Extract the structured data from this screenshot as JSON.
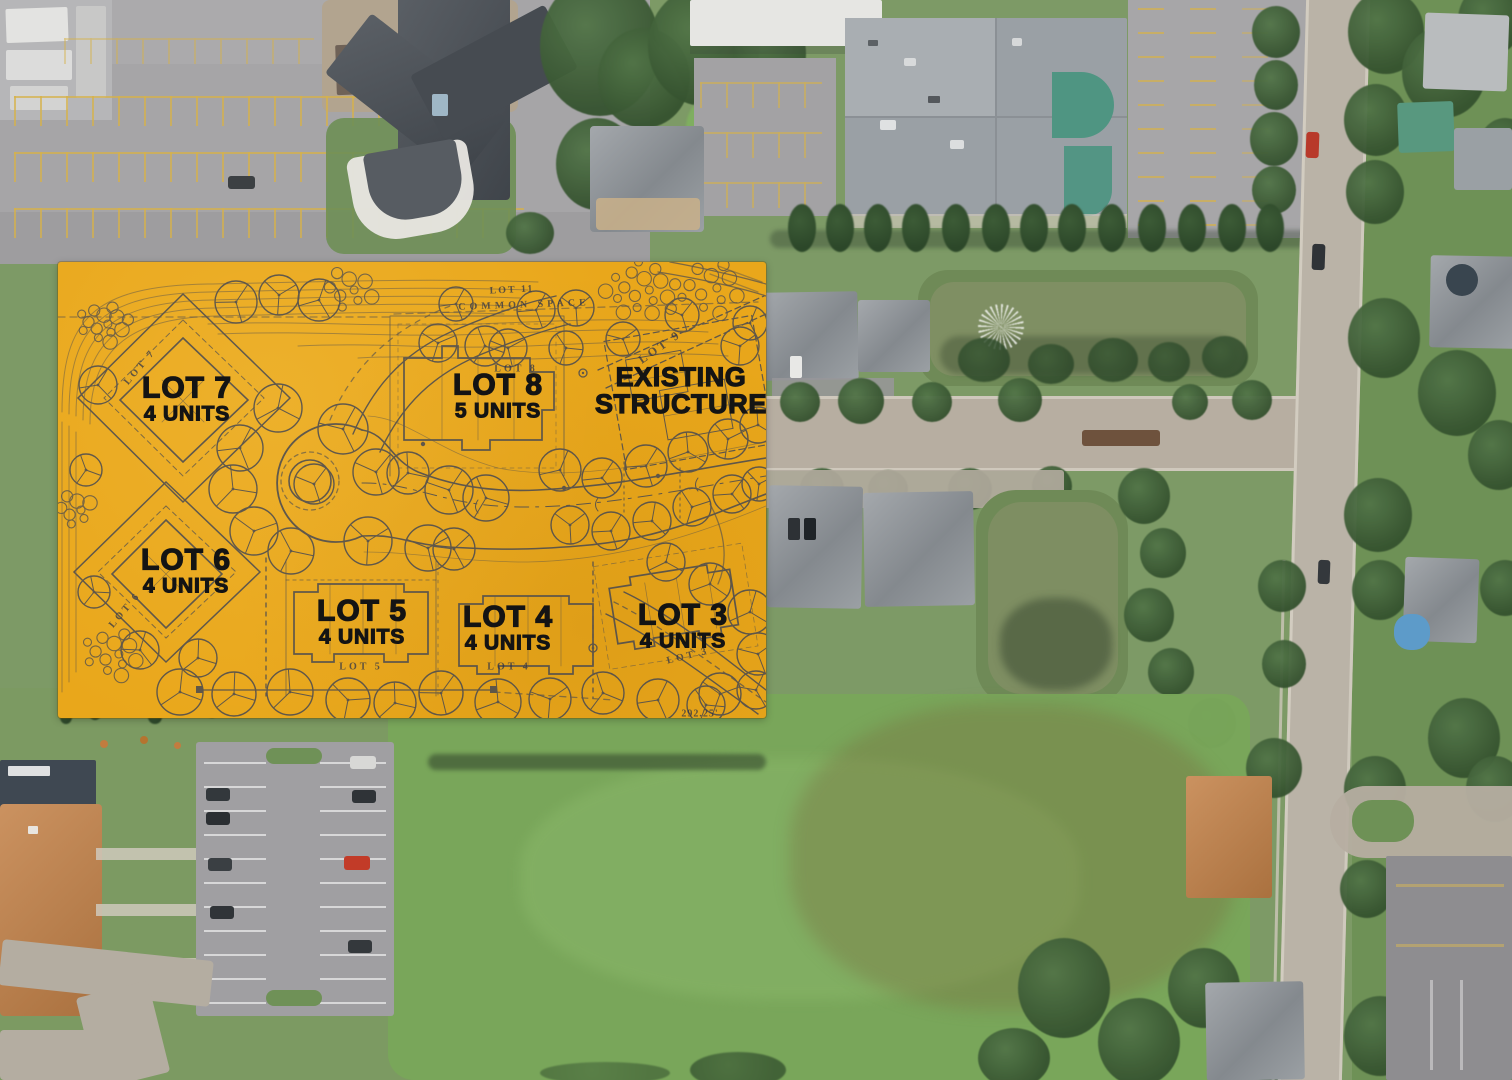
{
  "overlay": {
    "background_color": "#E9A71B",
    "linework_color": "#3A4156",
    "label_text_color": "#141414",
    "lot_labels": [
      {
        "title": "LOT 7",
        "subtitle": "4 UNITS",
        "x": 187,
        "y": 399,
        "variant": "lot"
      },
      {
        "title": "LOT 8",
        "subtitle": "5 UNITS",
        "x": 498,
        "y": 396,
        "variant": "lot"
      },
      {
        "title": "EXISTING",
        "subtitle": "STRUCTURE",
        "x": 681,
        "y": 391,
        "variant": "existing"
      },
      {
        "title": "LOT 6",
        "subtitle": "4 UNITS",
        "x": 186,
        "y": 571,
        "variant": "lot"
      },
      {
        "title": "LOT 5",
        "subtitle": "4 UNITS",
        "x": 362,
        "y": 622,
        "variant": "lot"
      },
      {
        "title": "LOT 4",
        "subtitle": "4 UNITS",
        "x": 508,
        "y": 628,
        "variant": "lot"
      },
      {
        "title": "LOT 3",
        "subtitle": "4 UNITS",
        "x": 683,
        "y": 626,
        "variant": "lot"
      }
    ],
    "plan_annotations": [
      {
        "text": "LOT 11",
        "x": 512,
        "y": 290,
        "rotate": -3,
        "size": 10,
        "spacing": 2
      },
      {
        "text": "COMMON SPACE",
        "x": 524,
        "y": 305,
        "rotate": -2,
        "size": 10,
        "spacing": 4
      },
      {
        "text": "LOT 9",
        "x": 660,
        "y": 347,
        "rotate": -35,
        "size": 12,
        "spacing": 3
      },
      {
        "text": "LOT 8",
        "x": 516,
        "y": 369,
        "rotate": 0,
        "size": 10,
        "spacing": 3
      },
      {
        "text": "LOT 7",
        "x": 140,
        "y": 367,
        "rotate": -50,
        "size": 10,
        "spacing": 3
      },
      {
        "text": "LOT 6",
        "x": 125,
        "y": 610,
        "rotate": -50,
        "size": 10,
        "spacing": 3
      },
      {
        "text": "LOT 5",
        "x": 361,
        "y": 667,
        "rotate": 0,
        "size": 10,
        "spacing": 3
      },
      {
        "text": "LOT 4",
        "x": 509,
        "y": 667,
        "rotate": 0,
        "size": 10,
        "spacing": 3
      },
      {
        "text": "LOT 3",
        "x": 688,
        "y": 656,
        "rotate": -14,
        "size": 10,
        "spacing": 3
      },
      {
        "text": "292.25'",
        "x": 700,
        "y": 714,
        "rotate": 0,
        "size": 10,
        "spacing": 1
      }
    ]
  }
}
